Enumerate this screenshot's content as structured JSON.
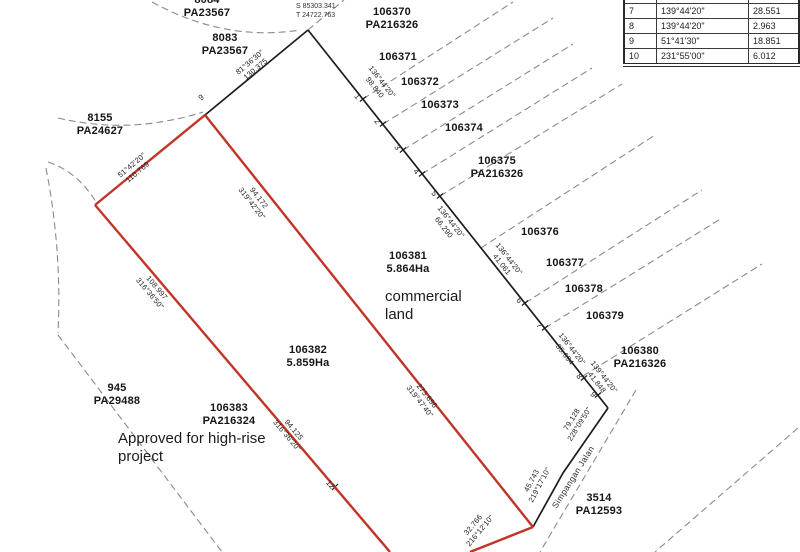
{
  "table": {
    "rows": [
      {
        "pt": "7",
        "bearing": "139°44'20\"",
        "dist": "28.551"
      },
      {
        "pt": "8",
        "bearing": "139°44'20\"",
        "dist": "2.963"
      },
      {
        "pt": "9",
        "bearing": "51°41'30\"",
        "dist": "18.851"
      },
      {
        "pt": "10",
        "bearing": "231°55'00\"",
        "dist": "6.012"
      }
    ]
  },
  "parcels": [
    {
      "lot": "8084",
      "plan": "PA23567"
    },
    {
      "lot": "8083",
      "plan": "PA23567"
    },
    {
      "lot": "106370",
      "plan": "PA216326"
    },
    {
      "lot": "106371",
      "plan": ""
    },
    {
      "lot": "106372",
      "plan": ""
    },
    {
      "lot": "106373",
      "plan": ""
    },
    {
      "lot": "106374",
      "plan": ""
    },
    {
      "lot": "106375",
      "plan": "PA216326"
    },
    {
      "lot": "106376",
      "plan": ""
    },
    {
      "lot": "106377",
      "plan": ""
    },
    {
      "lot": "106378",
      "plan": ""
    },
    {
      "lot": "106379",
      "plan": ""
    },
    {
      "lot": "106380",
      "plan": "PA216326"
    },
    {
      "lot": "8155",
      "plan": "PA24627"
    },
    {
      "lot": "945",
      "plan": "PA29488"
    },
    {
      "lot": "106383",
      "plan": "PA216324"
    },
    {
      "lot": "3514",
      "plan": "PA12593"
    },
    {
      "lot": "106381",
      "plan": "5.864Ha"
    },
    {
      "lot": "106382",
      "plan": "5.859Ha"
    }
  ],
  "segments": [
    {
      "line1": "81°36'30\"",
      "line2": "130.375"
    },
    {
      "line1": "136°44'20\"",
      "line2": "98.840"
    },
    {
      "line1": "136°44'20\"",
      "line2": "66.290"
    },
    {
      "line1": "136°44'20\"",
      "line2": "41.061"
    },
    {
      "line1": "136°44'20\"",
      "line2": "35.694"
    },
    {
      "line1": "139°44'20\"",
      "line2": "41.848"
    },
    {
      "line1": "79.128",
      "line2": "228°09'50\""
    },
    {
      "line1": "45.743",
      "line2": "219°17'10\""
    },
    {
      "line1": "32.766",
      "line2": "216°12'10\""
    },
    {
      "line1": "51°42'20\"",
      "line2": "110.769"
    },
    {
      "line1": "94.172",
      "line2": "319°42'20\""
    },
    {
      "line1": "108.997",
      "line2": "316°36'50\""
    },
    {
      "line1": "94.125",
      "line2": "316°36'20\""
    },
    {
      "line1": "273.696",
      "line2": "319°47'40\""
    }
  ],
  "points": [
    "9",
    "1",
    "2",
    "3",
    "4",
    "5",
    "6",
    "7",
    "8",
    "9",
    "12"
  ],
  "annotations": {
    "commercial_line1": "commercial",
    "commercial_line2": "land",
    "approved_line1": "Approved for high-rise",
    "approved_line2": "project",
    "road": "Simpangan Jalan",
    "datum_line1": "S 85303.341",
    "datum_line2": "T 24722.763"
  },
  "colors": {
    "boundary_red": "#c03527",
    "boundary_black": "#1c1c1c",
    "dashed_gray": "#8a8a8a"
  }
}
